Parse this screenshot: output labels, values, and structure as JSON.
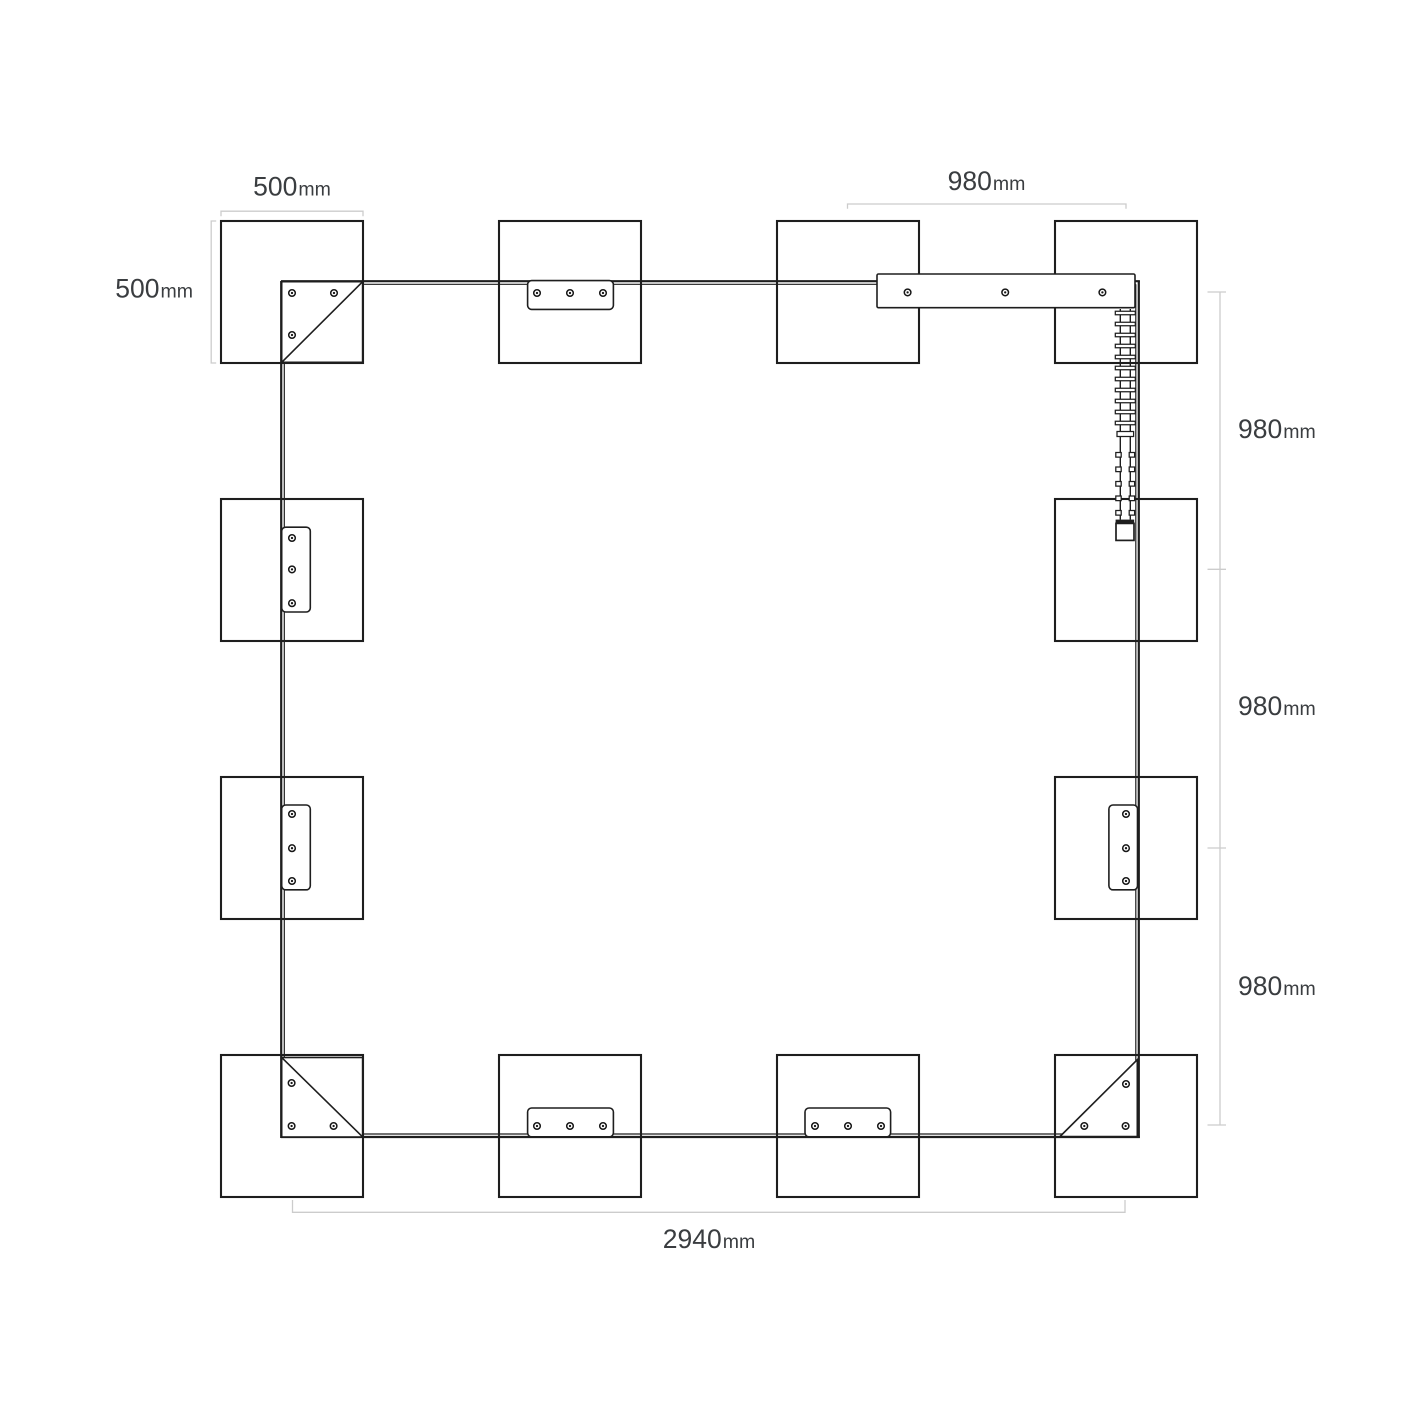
{
  "page": {
    "type": "technical-dimension-diagram",
    "background": "#ffffff"
  },
  "labels": {
    "post_width_top": {
      "value": "500",
      "unit": "mm"
    },
    "post_height_left": {
      "value": "500",
      "unit": "mm"
    },
    "span_top": {
      "value": "980",
      "unit": "mm"
    },
    "span_right_upper": {
      "value": "980",
      "unit": "mm"
    },
    "span_right_middle": {
      "value": "980",
      "unit": "mm"
    },
    "span_right_lower": {
      "value": "980",
      "unit": "mm"
    },
    "span_bottom": {
      "value": "2940",
      "unit": "mm"
    }
  },
  "colors": {
    "structure_line": "#1e1e1e",
    "dimension_line": "#cccccc",
    "label_text": "#3a3d40",
    "background": "#ffffff"
  },
  "components": {
    "posts": 12,
    "corner_brackets": 3,
    "connector_plates": 7,
    "zipper_assemblies": 1,
    "screw_holes": 30
  }
}
